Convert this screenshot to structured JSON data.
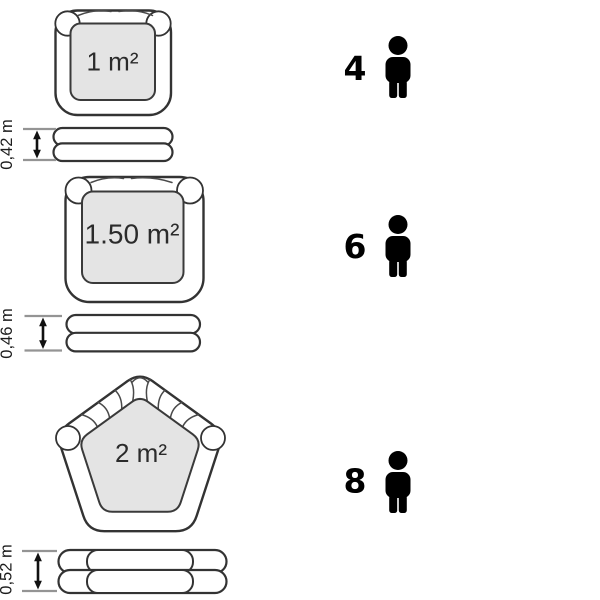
{
  "colors": {
    "background": "#ffffff",
    "outline": "#333333",
    "basin_fill": "#e4e4e4",
    "dimension_tick": "#949494",
    "icon_black": "#000000"
  },
  "icons": {
    "capacity": "person-icon",
    "dimension": "double-arrow-icon"
  },
  "rows": [
    {
      "shape": "rounded-square",
      "area": "1 m²",
      "height": "0,42 m",
      "capacity": "4"
    },
    {
      "shape": "rounded-square",
      "area": "1.50 m²",
      "height": "0,46 m",
      "capacity": "6"
    },
    {
      "shape": "pentagon",
      "area": "2 m²",
      "height": "0,52 m",
      "capacity": "8"
    }
  ]
}
